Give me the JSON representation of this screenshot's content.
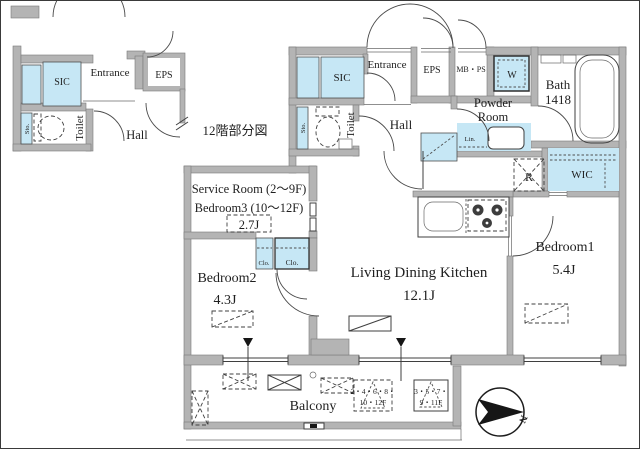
{
  "colors": {
    "accent_blue": "#c6e7f5",
    "wall_gray": "#b4b4b4",
    "line": "#3f3f3f"
  },
  "inset": {
    "caption": "12階部分図",
    "labels": {
      "sic": "SIC",
      "entrance": "Entrance",
      "eps": "EPS",
      "sto": "Sto.",
      "toilet": "Toilet",
      "hall": "Hall"
    }
  },
  "main": {
    "labels": {
      "sic": "SIC",
      "entrance": "Entrance",
      "eps": "EPS",
      "mbps": "MB・PS",
      "washer": "W",
      "bath": "Bath",
      "bath_size": "1418",
      "powder_line1": "Powder",
      "powder_line2": "Room",
      "sto": "Sto.",
      "toilet": "Toilet",
      "hall": "Hall",
      "lin": "Lin.",
      "wic": "WIC",
      "fridge": "R",
      "service_line1": "Service Room (2〜9F)",
      "service_line2": "Bedroom3 (10〜12F)",
      "service_size": "2.7J",
      "clo_small": "Clo.",
      "clo_large": "Clo.",
      "bedroom2": "Bedroom2",
      "bedroom2_size": "4.3J",
      "ldk": "Living Dining Kitchen",
      "ldk_size": "12.1J",
      "bedroom1": "Bedroom1",
      "bedroom1_size": "5.4J",
      "balcony": "Balcony",
      "note1_line1": "2・4・6・8・",
      "note1_line2": "10・12F",
      "note2_line1": "3・5・7・",
      "note2_line2": "9・11F"
    },
    "compass": {
      "north": "N"
    }
  }
}
